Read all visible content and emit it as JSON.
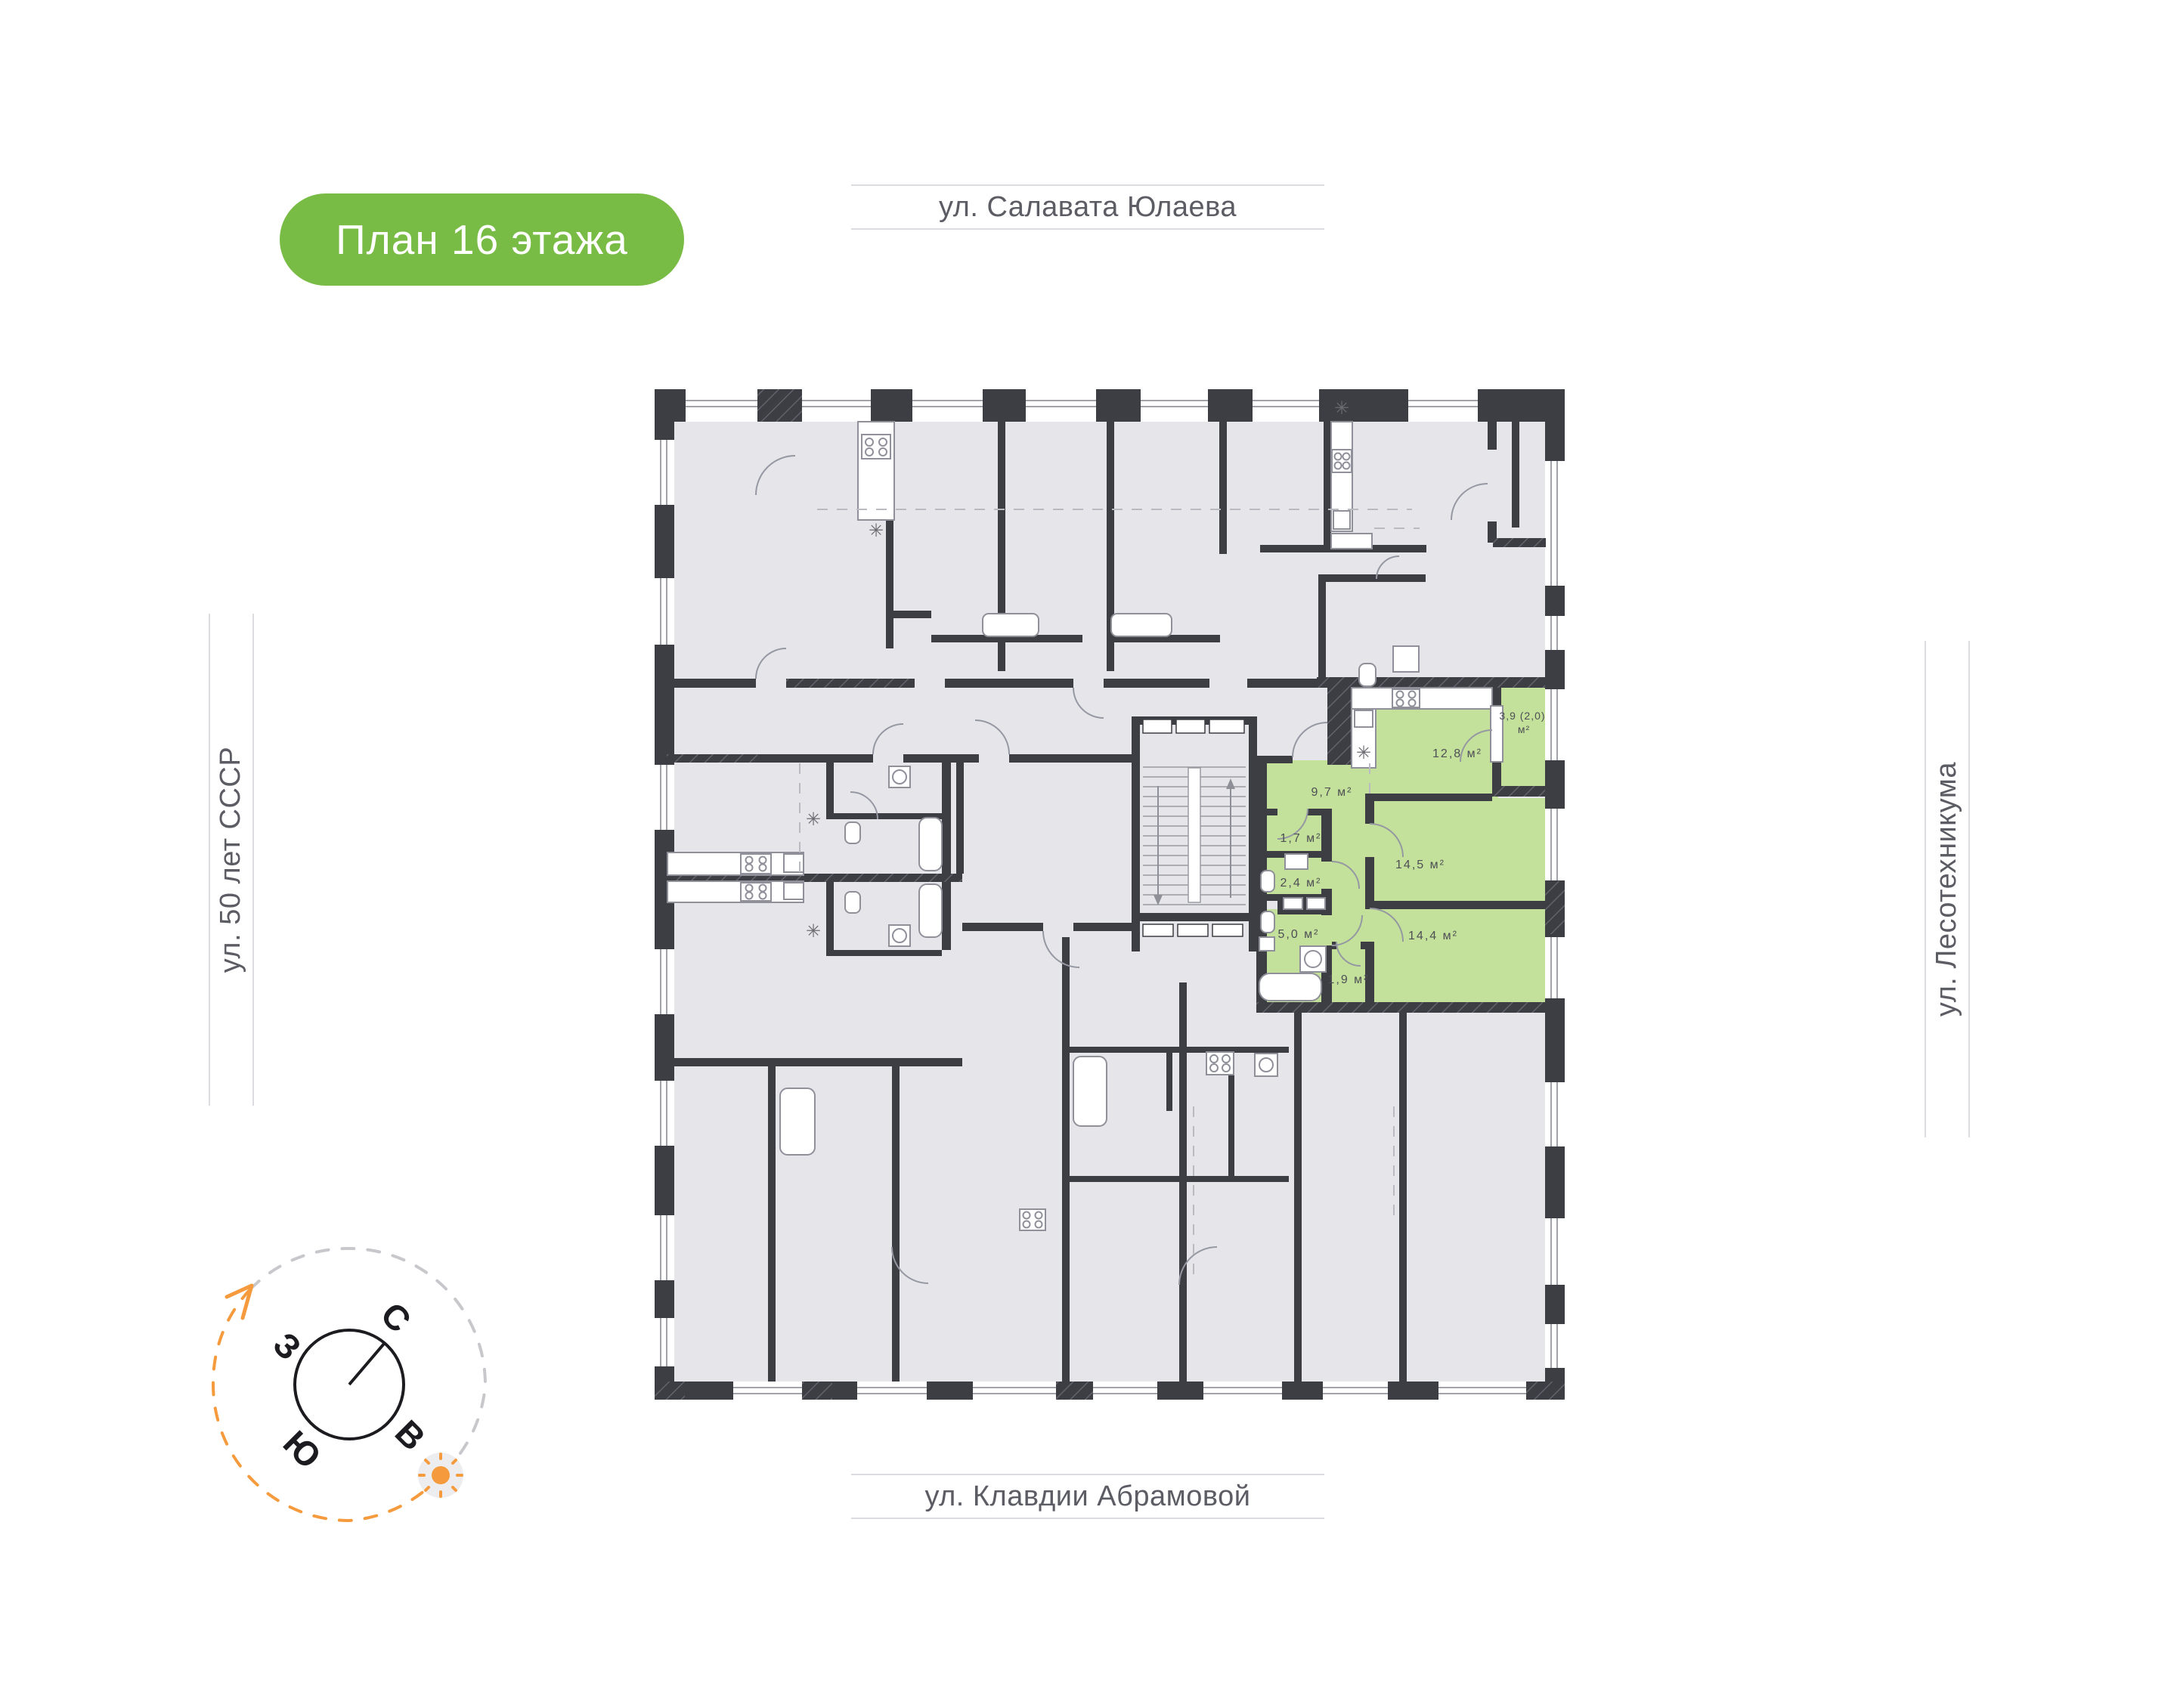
{
  "badge": {
    "label": "План 16 этажа"
  },
  "streets": {
    "top": "ул. Салавата Юлаева",
    "bottom": "ул. Клавдии Абрамовой",
    "left": "ул. 50 лет СССР",
    "right": "ул. Лесотехникума"
  },
  "compass": {
    "north": "С",
    "west": "З",
    "south": "Ю",
    "east": "В"
  },
  "apartment": {
    "rooms": {
      "kitchen_living": {
        "label": "12,8 м²"
      },
      "balcony": {
        "label_line1": "3,9 (2,0)",
        "label_line2": "м²"
      },
      "hallway": {
        "label": "9,7 м²"
      },
      "storage": {
        "label": "1,7 м²"
      },
      "wc": {
        "label": "2,4 м²"
      },
      "bathroom": {
        "label": "5,0 м²"
      },
      "laundry": {
        "label": "1,9 м²"
      },
      "bedroom_1": {
        "label": "14,5 м²"
      },
      "bedroom_2": {
        "label": "14,4 м²"
      }
    }
  },
  "colors": {
    "badge_green": "#79BC45",
    "apartment_green": "#C3E19A",
    "wall_dark": "#3D3D44",
    "floor_gray": "#E6E6EA",
    "accent_orange": "#F59B3E"
  }
}
